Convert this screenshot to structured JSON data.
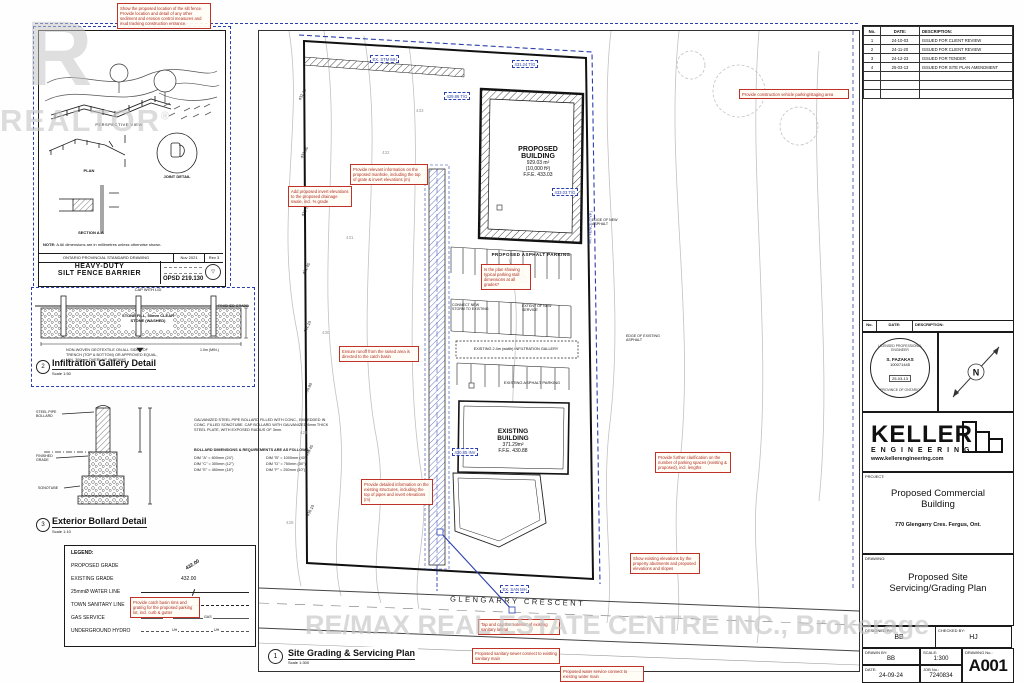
{
  "watermarks": {
    "realtor_logo": "R",
    "realtor_text": "REALTOR",
    "realtor_reg": "®",
    "remax": "RE/MAX REAL ESTATE CENTRE INC., Brokerage"
  },
  "revisions": {
    "headers": {
      "no": "No.",
      "date": "DATE:",
      "desc": "DESCRIPTION:"
    },
    "rows": [
      {
        "no": "1",
        "date": "24-10-03",
        "desc": "ISSUED FOR CLIENT REVIEW"
      },
      {
        "no": "2",
        "date": "24-11-20",
        "desc": "ISSUED FOR CLIENT REVIEW"
      },
      {
        "no": "3",
        "date": "24-12-23",
        "desc": "ISSUED FOR TENDER"
      },
      {
        "no": "4",
        "date": "25-03-13",
        "desc": "ISSUED FOR SITE PLAN AMENDMENT"
      }
    ]
  },
  "stamp": {
    "ring_top": "LICENSED PROFESSIONAL ENGINEER",
    "name": "S. FAZAKAS",
    "license": "100071445",
    "date": "25-03-13",
    "ring_bottom": "PROVINCE OF ONTARIO"
  },
  "north": {
    "label": "N"
  },
  "company": {
    "name": "KELLER",
    "sub": "E N G I N E E R I N G",
    "url": "www.kellerengineering.com"
  },
  "title_block": {
    "project_label": "PROJECT:",
    "project_line1": "Proposed Commercial",
    "project_line2": "Building",
    "project_address": "770 Glengarry Cres. Fergus, Ont.",
    "drawing_label": "DRAWING:",
    "drawing_line1": "Proposed Site",
    "drawing_line2": "Servicing/Grading Plan",
    "designed_label": "DESIGNED BY:",
    "designed": "BB",
    "checked_label": "CHECKED BY:",
    "checked": "HJ",
    "drawn_label": "DRAWN BY:",
    "drawn": "BB",
    "scale_label": "SCALE:",
    "scale": "1:300",
    "date_label": "DATE:",
    "date": "24-09-24",
    "job_label": "JOB No.:",
    "job": "7240834",
    "dwgno_label": "DRAWING No.:",
    "dwgno": "A001"
  },
  "silt_detail": {
    "perspective": "PERSPECTIVE VIEW",
    "plan": "PLAN",
    "section": "SECTION A-A",
    "joint": "JOINT DETAIL",
    "note_title": "NOTE:",
    "note_text": "A  All dimensions are in millimetres unless otherwise shown.",
    "std_line": "ONTARIO PROVINCIAL STANDARD DRAWING",
    "std_date": "Nov 2021",
    "std_rev": "Rev 3",
    "title_line1": "HEAVY-DUTY",
    "title_line2": "SILT FENCE BARRIER",
    "opsd": "OPSD 219.130"
  },
  "infiltration_detail": {
    "number": "2",
    "title": "Infiltration Gallery Detail",
    "scale": "Scale 1:50",
    "cap_label": "CAP WITH LID",
    "stone_label": "STONE FILL, 50mm CLEAR STONE (WASHED)",
    "geotextile_note": "NON-WOVEN GEOTEXTILE ON ALL SIDES OF TRENCH (TOP & BOTTOM) OR APPROVED EQUAL, MIN. 300mm OVERLAP @ SEAMS",
    "grade_label": "FINISHED GRADE",
    "depth_label": "1.0m (MIN.)"
  },
  "bollard_detail": {
    "number": "3",
    "title": "Exterior Bollard Detail",
    "scale": "Scale 1:10",
    "label_pipe": "STEEL PIPE BOLLARD",
    "label_grade": "FINISHED GRADE",
    "label_sonotube": "SONOTUBE",
    "note1": "GALVANIZED STEEL PIPE BOLLARD FILLED WITH CONC., EMBEDDED IN CONC. FILLED SONOTUBE. CAP BOLLARD WITH GALVANIZED 6mm THICK STEEL PLATE, WITH EXPOSED RADIUS OF 3mm.",
    "note2": "BOLLARD DIMENSIONS & REQUIREMENTS ARE AS FOLLOWS:",
    "dims": [
      "DIM \"A\" = 600mm (24\")",
      "DIM \"B\" = 1000mm (40\")",
      "DIM \"C\" = 300mm (12\")",
      "DIM \"D\" = 750mm (30\")",
      "DIM \"E\" = 450mm (18\")",
      "DIM \"F\" = 250mm (10\")"
    ]
  },
  "legend": {
    "title": "LEGEND:",
    "proposed_grade": "PROPOSED GRADE",
    "proposed_grade_sample": "432.00",
    "existing_grade": "EXISTING GRADE",
    "existing_grade_sample": "432.00",
    "water": "25mmØ WATER LINE",
    "sanitary": "TOWN SANITARY LINE",
    "gas": "GAS SERVICE",
    "gas_mark": "GAS",
    "hydro": "UNDERGROUND HYDRO",
    "hydro_mark": "UH"
  },
  "plan": {
    "proposed_building": {
      "l1": "PROPOSED",
      "l2": "BUILDING",
      "area": "929.03 m²",
      "area2": "(10,000 ft²)",
      "ffe": "F.F.E. 433.03"
    },
    "existing_building": {
      "l1": "EXISTING",
      "l2": "BUILDING",
      "area": "371.29m²",
      "ffe": "F.F.E. 430.88"
    },
    "proposed_parking": "PROPOSED ASPHALT PARKING",
    "existing_parking": "EXISTING ASPHALT PARKING",
    "gallery_strip": "EXISTING 2.4m (width) INFILTRATION GALLERY",
    "connect_storm": "CONNECT NEW STORM TO EXISTING",
    "extent_service": "EXTENT OF NEW SERVICE",
    "edge_new": "EDGE OF NEW ASPHALT",
    "edge_exist": "EDGE OF EXISTING ASPHALT",
    "silt_fence": "SILT FENCE (TYP.)",
    "street": "GLENGARRY CRESCENT",
    "grade_ticks": [
      "432.10",
      "431.95",
      "431.70",
      "431.45",
      "431.10",
      "430.80",
      "430.45",
      "430.10"
    ],
    "contour_labels": [
      "428",
      "429",
      "430",
      "431",
      "432",
      "433"
    ]
  },
  "blue_callouts": [
    {
      "text": "EX. STM MH"
    },
    {
      "text": "429.86 T/G"
    },
    {
      "text": "431.24 T/G"
    },
    {
      "text": "433.03 T/G"
    },
    {
      "text": "430.85 INV"
    },
    {
      "text": "EX. SAN MH"
    }
  ],
  "red_notes": [
    {
      "text": "Show the proposed location of the silt fence. Provide location and detail of any other sediment and erosion control measures and mud tracking construction entrance."
    },
    {
      "text": "Provide construction vehicle parking/staging area"
    },
    {
      "text": "Provide relevant information on the proposed manhole, including the top of grate & invert elevations (m)"
    },
    {
      "text": "Add proposed invert elevations to the proposed drainage swale, incl. % grade"
    },
    {
      "text": "Is the plan showing typical parking stall dimensions at all grades?"
    },
    {
      "text": "Ensure runoff from the raised area is directed to the catch basin"
    },
    {
      "text": "Provide further clarification on the number of parking spaces (existing & proposed), incl. lengths"
    },
    {
      "text": "Provide detailed information on the existing structures, including the top of pipes and invert elevations (m)"
    },
    {
      "text": "Show existing elevations by the property abutments and proposed elevations and slopes"
    },
    {
      "text": "Provide catch basin rims and grating for the proposed parking lot, incl. curb & gutter"
    },
    {
      "text": "Tap and cap the 'exterior' of existing sanitary lateral"
    },
    {
      "text": "Proposed sanitary sewer connect to existing sanitary main"
    },
    {
      "text": "Proposed water service connect to existing water main"
    }
  ],
  "plan_title": {
    "number": "1",
    "title": "Site Grading & Servicing Plan",
    "scale": "Scale 1:300"
  }
}
